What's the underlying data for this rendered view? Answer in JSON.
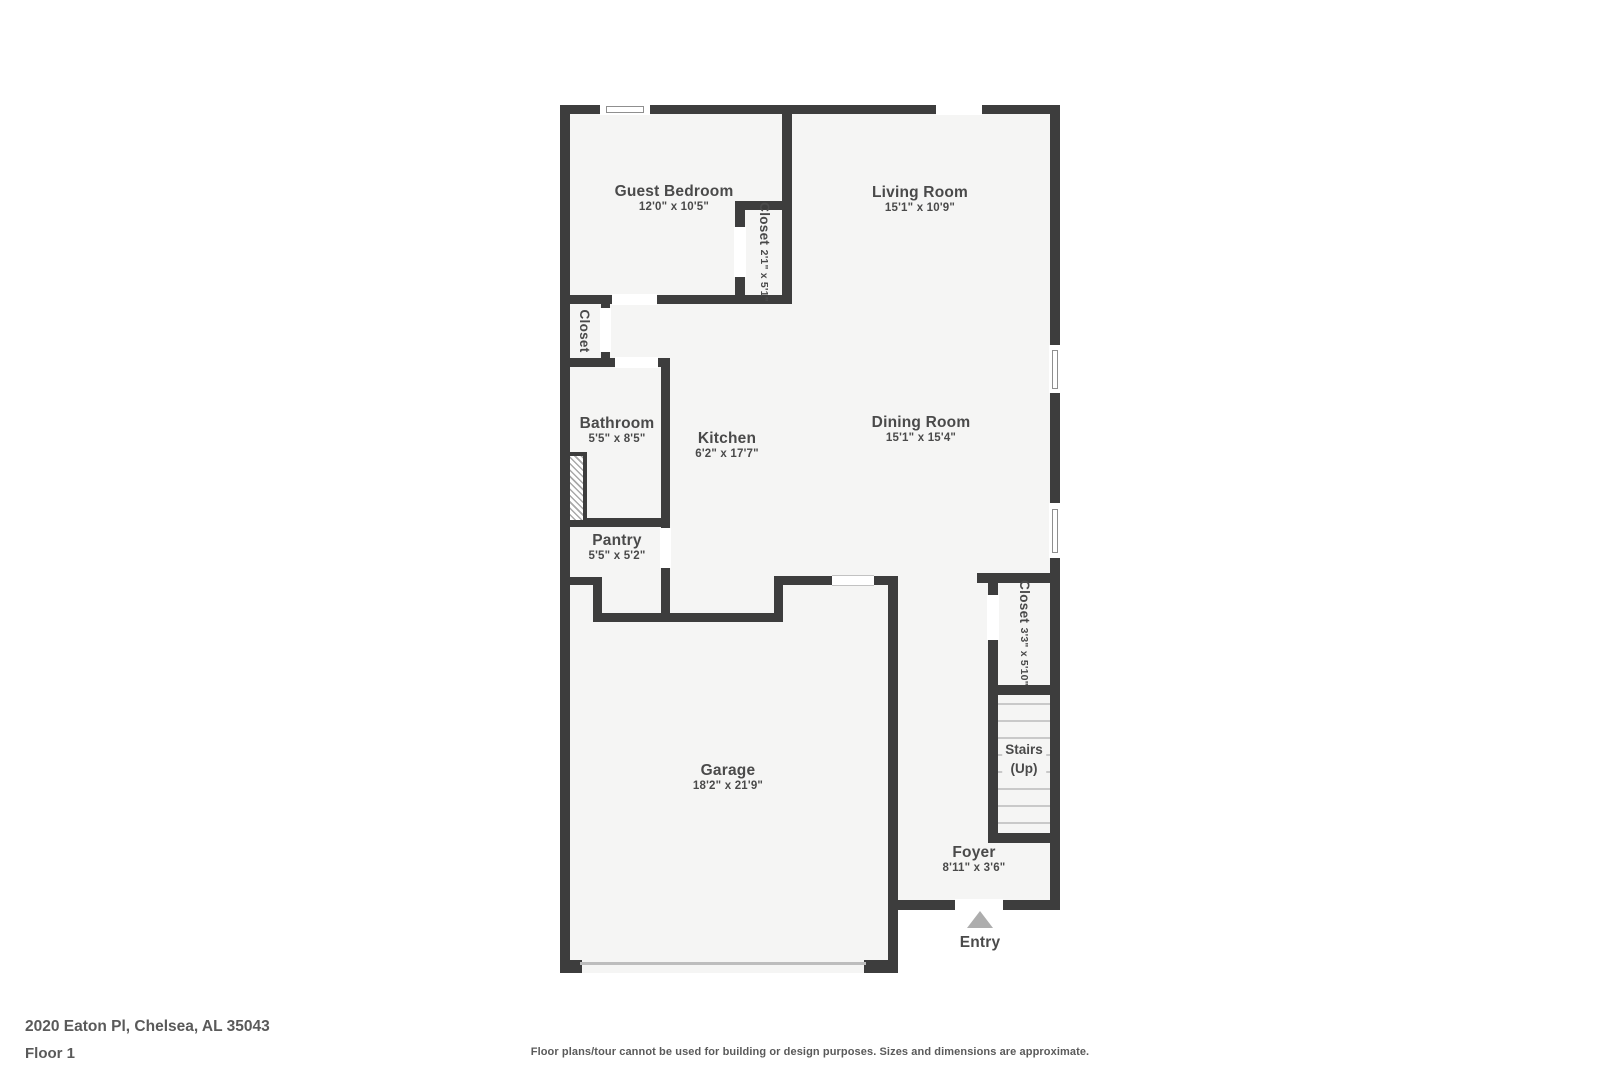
{
  "floorplan": {
    "rooms": {
      "guest_bedroom": {
        "name": "Guest Bedroom",
        "dims": "12'0\" x 10'5\""
      },
      "living_room": {
        "name": "Living Room",
        "dims": "15'1\" x 10'9\""
      },
      "bedroom_closet": {
        "name": "Closet",
        "dims": "2'1\" x 5'1\""
      },
      "hall_closet": {
        "name": "Closet"
      },
      "bathroom": {
        "name": "Bathroom",
        "dims": "5'5\" x 8'5\""
      },
      "kitchen": {
        "name": "Kitchen",
        "dims": "6'2\" x 17'7\""
      },
      "dining_room": {
        "name": "Dining Room",
        "dims": "15'1\" x 15'4\""
      },
      "pantry": {
        "name": "Pantry",
        "dims": "5'5\" x 5'2\""
      },
      "garage": {
        "name": "Garage",
        "dims": "18'2\" x 21'9\""
      },
      "foyer_closet": {
        "name": "Closet",
        "dims": "3'3\" x 5'10\""
      },
      "stairs": {
        "name": "Stairs",
        "direction": "(Up)"
      },
      "foyer": {
        "name": "Foyer",
        "dims": "8'11\" x 3'6\""
      },
      "entry": {
        "name": "Entry"
      }
    },
    "colors": {
      "wall": "#3d3d3d",
      "floor": "#f5f5f4",
      "label_text": "#4a4a4a",
      "stair_tread": "#c9c9c9",
      "entry_arrow": "#adadad"
    },
    "footer": {
      "address": "2020 Eaton Pl, Chelsea, AL 35043",
      "floor": "Floor 1",
      "disclaimer": "Floor plans/tour cannot be used for building or design purposes. Sizes and dimensions are approximate."
    }
  }
}
